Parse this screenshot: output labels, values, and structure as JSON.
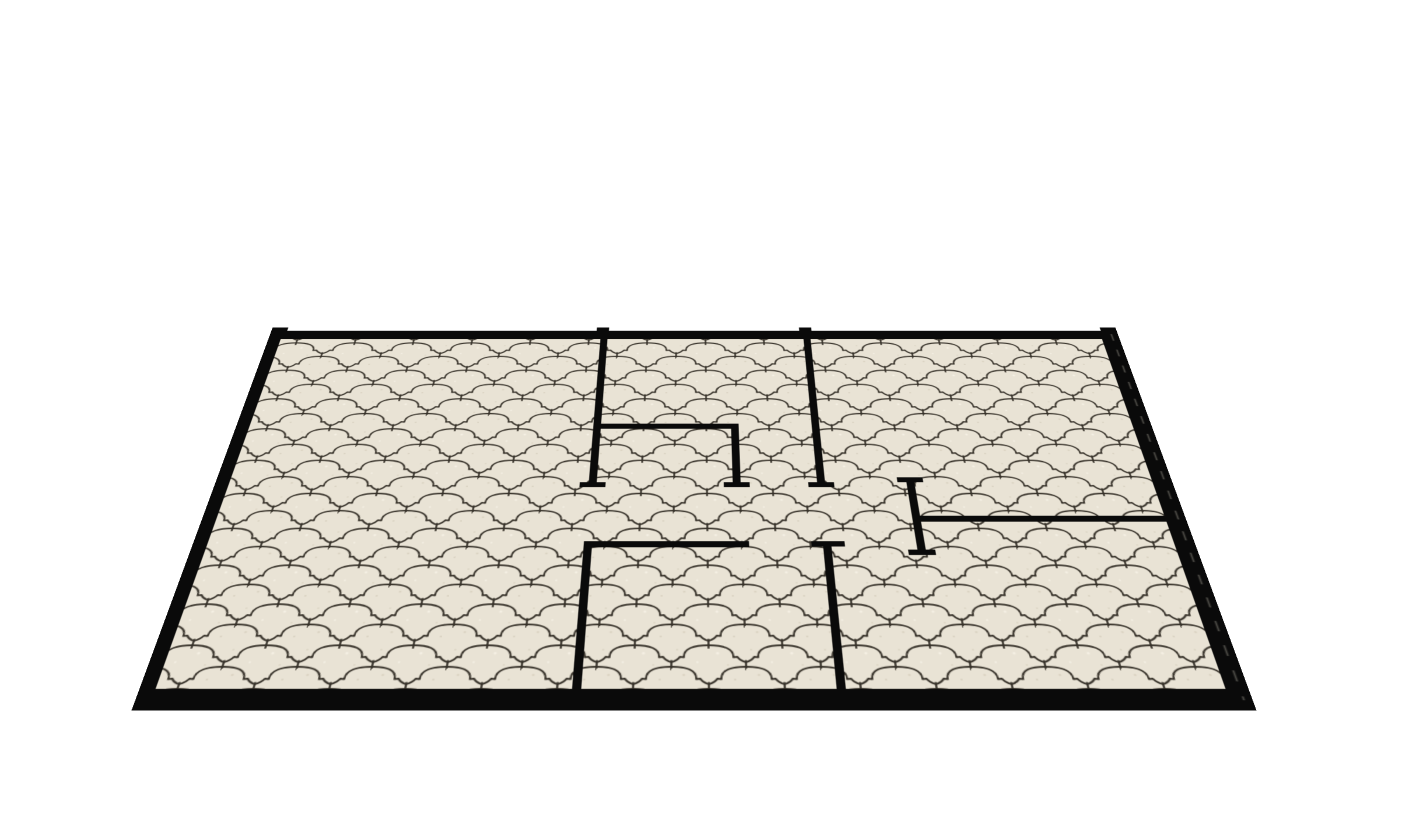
{
  "scene": {
    "title": "3D perspective render of an apartment floor plan with black walls on a cream arabesque-tiled floor",
    "background_color": "#ffffff",
    "view": {
      "plan_width": 964,
      "plan_height": 520,
      "left_px": 212,
      "top_px": 232,
      "perspective_px": 1308,
      "rotate_x_deg": 45
    },
    "floor": {
      "base_fill": "#e9e3d5",
      "grout_color": "#37322a",
      "grout_width": 1.8,
      "pattern_name": "moroccan-arabesque-lantern-tile",
      "cell": {
        "w": 66,
        "h": 48,
        "row_offset_x": 33,
        "row_offset_y": 24
      },
      "tile_cloud_path": "M -32.5,17 C -29.5,15.5 -27,14 -25.5,11 L -22,11.5 C -22.5,1.5 -13,-2 0,-2 C 13,-2 22.5,1.5 22,11.5 L 25.5,11 C 27,14 29.5,15.5 32.5,17",
      "tile_tick_path": "M 33,15.5 L 33,25",
      "tile_positions": [
        [
          0,
          0
        ],
        [
          66,
          0
        ],
        [
          33,
          24
        ],
        [
          -33,
          24
        ],
        [
          99,
          24
        ],
        [
          0,
          48
        ],
        [
          66,
          48
        ],
        [
          33,
          -24
        ]
      ],
      "speckles": [
        {
          "x": 11,
          "y": 7,
          "r": 1.3,
          "fill": "#dcd5c4"
        },
        {
          "x": 41,
          "y": 31,
          "r": 1.5,
          "fill": "#f4efe3"
        },
        {
          "x": 56,
          "y": 12,
          "r": 1.0,
          "fill": "#d8d1c0"
        },
        {
          "x": 23,
          "y": 41,
          "r": 1.2,
          "fill": "#f2ede1"
        },
        {
          "x": 5,
          "y": 27,
          "r": 0.9,
          "fill": "#dbd4c3"
        },
        {
          "x": 50,
          "y": 44,
          "r": 1.0,
          "fill": "#ddd6c5"
        }
      ],
      "inner_rect": {
        "x": 10,
        "y": 11,
        "w": 946,
        "h": 496
      }
    },
    "walls": {
      "color": "#0a0a0a",
      "edge_dash_color": "#55534d",
      "outer": [
        {
          "name": "wall-outer-top",
          "x": 0,
          "y": 0,
          "w": 964,
          "h": 15
        },
        {
          "name": "wall-outer-bottom",
          "x": 0,
          "y": 502,
          "w": 964,
          "h": 18
        },
        {
          "name": "wall-outer-bottom-face",
          "x": 0,
          "y": 520,
          "w": 964,
          "h": 5
        },
        {
          "name": "wall-outer-left",
          "x": 0,
          "y": 0,
          "w": 14,
          "h": 520
        },
        {
          "name": "wall-outer-right",
          "x": 944,
          "y": 0,
          "w": 20,
          "h": 520
        }
      ],
      "top_edge_bumps": [
        {
          "name": "wall-top-left-corner-cap",
          "x": 0,
          "y": -6,
          "w": 18,
          "h": 8
        },
        {
          "name": "wall-a-top-cap",
          "x": 371,
          "y": -6,
          "w": 14,
          "h": 8
        },
        {
          "name": "wall-d-top-cap",
          "x": 602,
          "y": -6,
          "w": 14,
          "h": 8
        },
        {
          "name": "wall-top-right-corner-cap",
          "x": 946,
          "y": -6,
          "w": 18,
          "h": 8
        }
      ],
      "inner": [
        {
          "name": "wall-a-bedroom-left-divider",
          "x": 376,
          "y": 15,
          "w": 8,
          "h": 231
        },
        {
          "name": "wall-b-closet-north",
          "x": 376,
          "y": 158,
          "w": 153,
          "h": 8
        },
        {
          "name": "wall-c-closet-east",
          "x": 521,
          "y": 158,
          "w": 8,
          "h": 88
        },
        {
          "name": "wall-d-top-middle-right",
          "x": 606,
          "y": 15,
          "w": 8,
          "h": 231
        },
        {
          "name": "wall-corridor-south",
          "x": 376,
          "y": 327,
          "w": 159,
          "h": 8
        },
        {
          "name": "wall-h-bottom-left-divider",
          "x": 376,
          "y": 327,
          "w": 8,
          "h": 179
        },
        {
          "name": "wall-g-bottom-middle-right",
          "x": 606,
          "y": 331,
          "w": 8,
          "h": 175
        },
        {
          "name": "wall-e-right-stub",
          "x": 696,
          "y": 239,
          "w": 8,
          "h": 106
        },
        {
          "name": "wall-f-right-room-divider",
          "x": 700,
          "y": 293,
          "w": 250,
          "h": 8
        }
      ],
      "end_caps": [
        {
          "name": "cap-wall-a-south",
          "x": 367,
          "y": 246,
          "w": 26,
          "h": 7
        },
        {
          "name": "cap-wall-c-south",
          "x": 512,
          "y": 246,
          "w": 26,
          "h": 7
        },
        {
          "name": "cap-wall-d-south",
          "x": 597,
          "y": 246,
          "w": 26,
          "h": 7
        },
        {
          "name": "cap-wall-g-north",
          "x": 595,
          "y": 327,
          "w": 32,
          "h": 7
        },
        {
          "name": "cap-wall-e-north",
          "x": 687,
          "y": 239,
          "w": 26,
          "h": 7
        },
        {
          "name": "cap-wall-e-south",
          "x": 687,
          "y": 338,
          "w": 26,
          "h": 7
        }
      ],
      "right_wall_dash": {
        "x": 956.5,
        "y1": 6,
        "y2": 514,
        "dash": "12 16",
        "width": 1.8
      }
    }
  }
}
